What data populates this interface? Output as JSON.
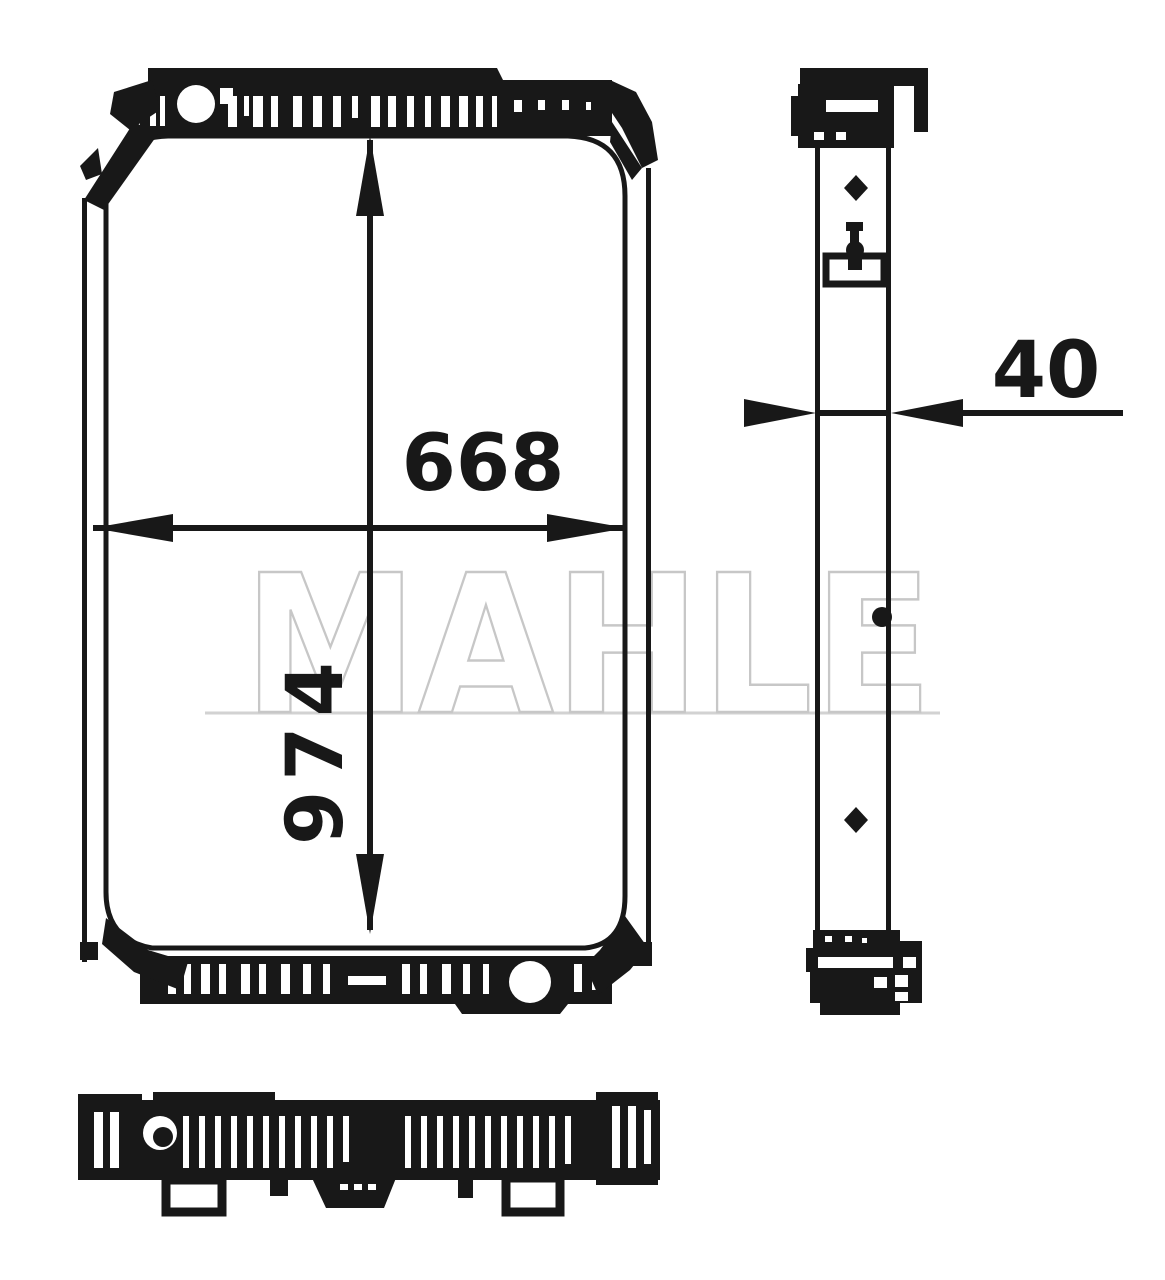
{
  "drawing": {
    "watermark": "MAHLE",
    "dimensions": {
      "width": "668",
      "height": "974",
      "depth": "40"
    },
    "colors": {
      "ink": "#181818",
      "watermark": "#c7c7c7",
      "background": "#ffffff"
    }
  }
}
